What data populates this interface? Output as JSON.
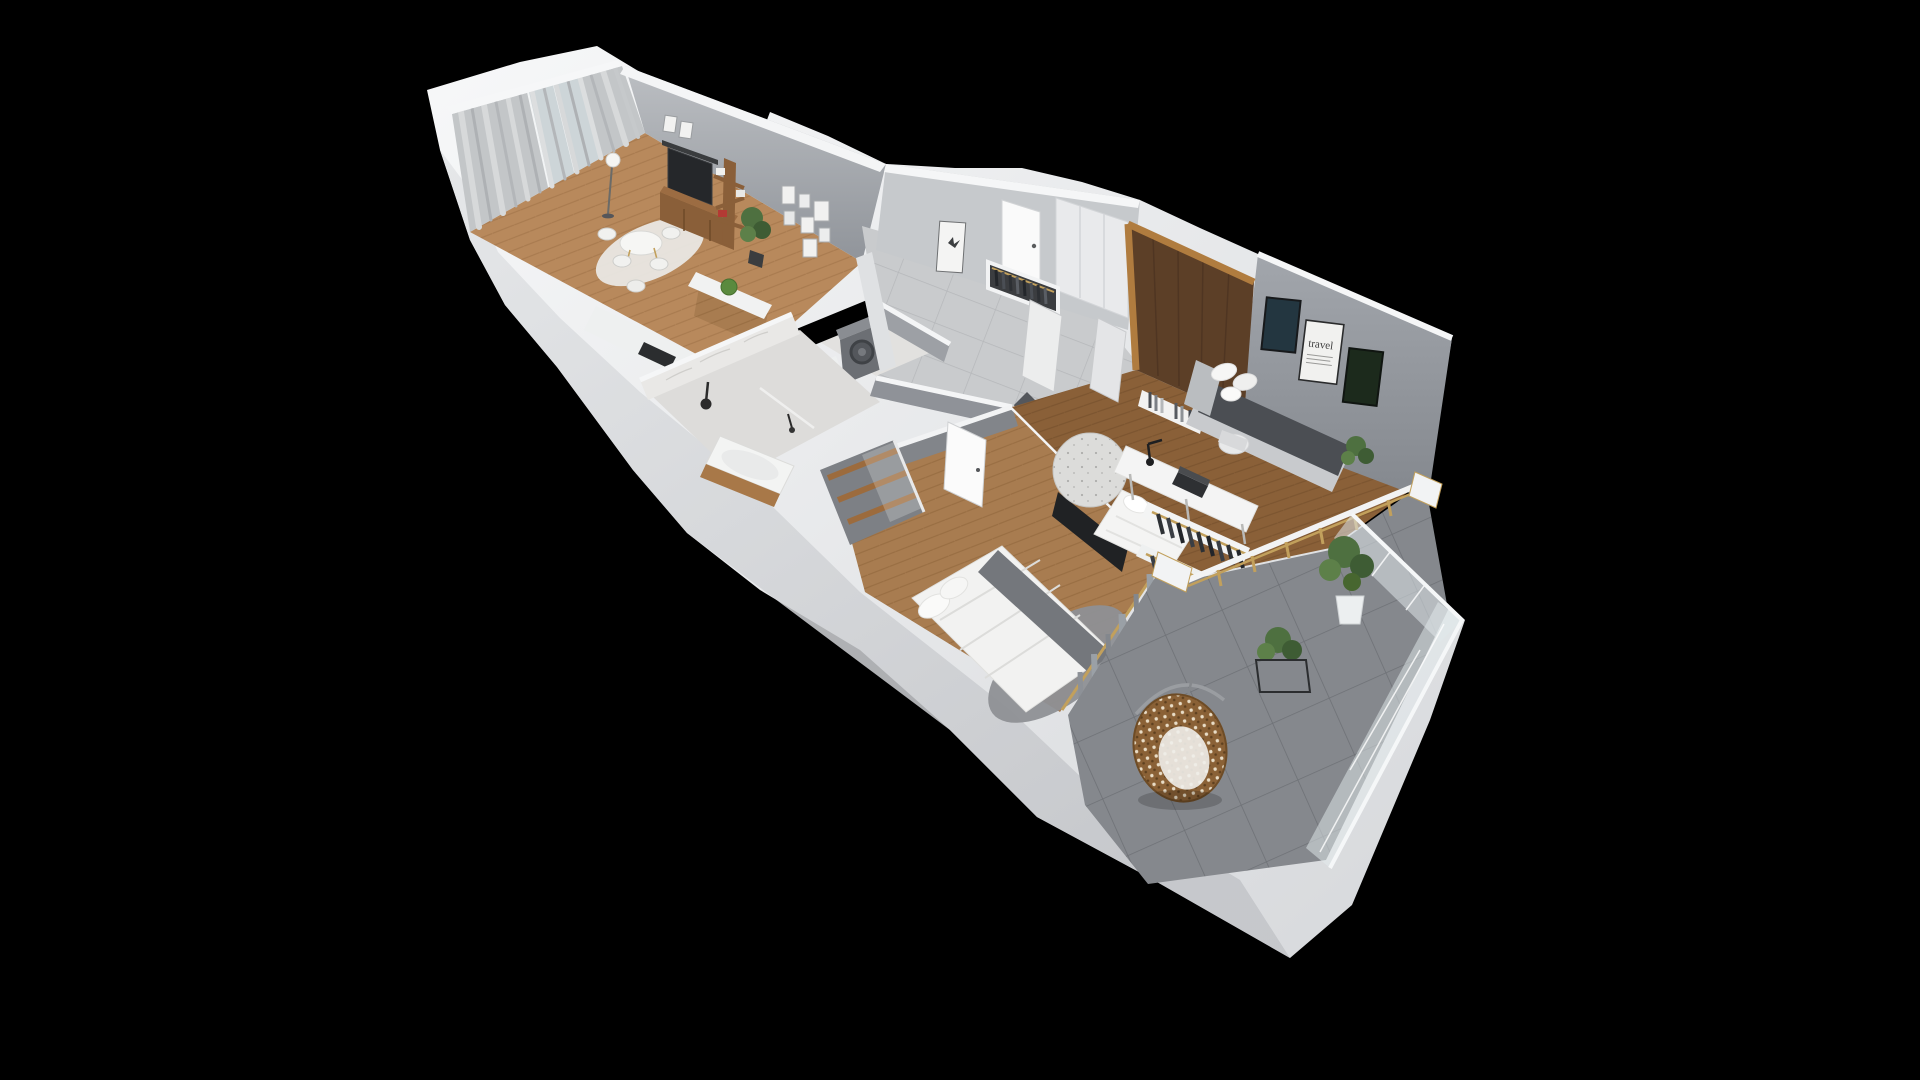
{
  "scene": {
    "kind": "3d-apartment-floorplan-render",
    "view": "isometric cutaway from above",
    "background": "#000000",
    "visible_text": [
      "travel"
    ]
  },
  "poster": {
    "title": "travel"
  },
  "palette": {
    "outer_wall": "#eef0f2",
    "outer_wall_shade": "#cfd2d5",
    "inner_wall": "#9aa0a6",
    "accent_wall_dark": "#54575c",
    "wood_floor_light": "#b8895c",
    "wood_floor_mid": "#a87c50",
    "wood_floor_dark": "#8a6038",
    "tile_hall": "#c9cbcd",
    "tile_balcony": "#85888d",
    "marble": "#e6e5e3",
    "walnut_wardrobe": "#5c3f27",
    "oak_frame": "#b07c3f",
    "gold_accent": "#c2a05c",
    "textile_dark": "#4b4e53",
    "textile_white": "#f3f3f2",
    "plant_green": "#4e7040",
    "rattan": "#8a6136"
  },
  "rooms": [
    {
      "id": "living-room",
      "label": "Living room",
      "floor": "herringbone wood",
      "items": [
        "sheer curtains",
        "balcony glass door",
        "floor lamp",
        "round dining table",
        "dining chairs",
        "area rug",
        "wall TV",
        "TV shelf",
        "media console",
        "tree bookshelf",
        "gallery picture frames",
        "potted plant"
      ]
    },
    {
      "id": "kitchen",
      "label": "Kitchen",
      "floor": "herringbone wood",
      "items": [
        "island with moss plant",
        "white worktop",
        "cooktop"
      ]
    },
    {
      "id": "entrance-hall",
      "label": "Hallway / Entrance",
      "floor": "stone tile",
      "items": [
        "entrance door",
        "butterfly picture frame",
        "open coat wardrobe",
        "white closets",
        "walnut wardrobe"
      ]
    },
    {
      "id": "wc-laundry",
      "label": "WC / Laundry",
      "floor": "marble",
      "items": [
        "washing machine",
        "toilet"
      ]
    },
    {
      "id": "bathroom",
      "label": "Bathroom",
      "floor": "marble",
      "items": [
        "rain shower",
        "glass screen",
        "bathtub with wood panel"
      ]
    },
    {
      "id": "master-bedroom",
      "label": "Bedroom",
      "floor": "herringbone wood",
      "items": [
        "double bed",
        "pillows",
        "gray throw",
        "fluffy rug",
        "wall TV panel",
        "open wood wardrobe",
        "door",
        "curtains to balcony"
      ]
    },
    {
      "id": "office-bedroom",
      "label": "Office / Guest room",
      "floor": "herringbone wood",
      "items": [
        "daybed sofa",
        "pillows",
        "framed art (3)",
        "travel poster",
        "desk",
        "laptop",
        "desk lamp",
        "desk chair",
        "single bed",
        "round rug",
        "book ledge",
        "clothes racks"
      ]
    },
    {
      "id": "balcony",
      "label": "Balcony",
      "floor": "gray tile",
      "items": [
        "hanging egg chair",
        "potted tree",
        "plant in wire cube stand",
        "glass balustrade",
        "gold window mullions"
      ]
    }
  ]
}
